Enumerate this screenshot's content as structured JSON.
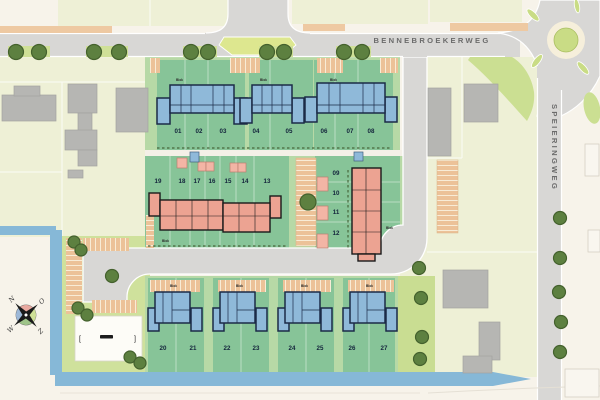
{
  "streets": {
    "main_road": "BENNEBROEKERWEG",
    "side_road": "SPEIERINGWEG"
  },
  "compass": {
    "north": "N",
    "east": "O",
    "south": "Z",
    "west": "W"
  },
  "block_label_text": "Blok",
  "site_sign": {
    "bracket_left": "[",
    "bracket_right": "]"
  },
  "plots": [
    {
      "n": "01",
      "x": 178,
      "y": 133
    },
    {
      "n": "02",
      "x": 199,
      "y": 133
    },
    {
      "n": "03",
      "x": 223,
      "y": 133
    },
    {
      "n": "04",
      "x": 256,
      "y": 133
    },
    {
      "n": "05",
      "x": 289,
      "y": 133
    },
    {
      "n": "06",
      "x": 324,
      "y": 133
    },
    {
      "n": "07",
      "x": 350,
      "y": 133
    },
    {
      "n": "08",
      "x": 371,
      "y": 133
    },
    {
      "n": "09",
      "x": 336,
      "y": 175
    },
    {
      "n": "10",
      "x": 336,
      "y": 195
    },
    {
      "n": "11",
      "x": 336,
      "y": 214
    },
    {
      "n": "12",
      "x": 336,
      "y": 235
    },
    {
      "n": "13",
      "x": 267,
      "y": 183
    },
    {
      "n": "14",
      "x": 245,
      "y": 183
    },
    {
      "n": "15",
      "x": 228,
      "y": 183
    },
    {
      "n": "16",
      "x": 212,
      "y": 183
    },
    {
      "n": "17",
      "x": 197,
      "y": 183
    },
    {
      "n": "18",
      "x": 182,
      "y": 183
    },
    {
      "n": "19",
      "x": 158,
      "y": 183
    },
    {
      "n": "20",
      "x": 163,
      "y": 350
    },
    {
      "n": "21",
      "x": 193,
      "y": 350
    },
    {
      "n": "22",
      "x": 227,
      "y": 350
    },
    {
      "n": "23",
      "x": 256,
      "y": 350
    },
    {
      "n": "24",
      "x": 292,
      "y": 350
    },
    {
      "n": "25",
      "x": 320,
      "y": 350
    },
    {
      "n": "26",
      "x": 352,
      "y": 350
    },
    {
      "n": "27",
      "x": 384,
      "y": 350
    }
  ],
  "block_labels": [
    {
      "x": 176,
      "y": 81
    },
    {
      "x": 260,
      "y": 81
    },
    {
      "x": 330,
      "y": 81
    },
    {
      "x": 162,
      "y": 242
    },
    {
      "x": 386,
      "y": 229
    },
    {
      "x": 170,
      "y": 287
    },
    {
      "x": 236,
      "y": 287
    },
    {
      "x": 301,
      "y": 287
    },
    {
      "x": 366,
      "y": 287
    }
  ],
  "trees": [
    [
      16,
      52,
      7.5
    ],
    [
      39,
      52,
      7.5
    ],
    [
      94,
      52,
      7.5
    ],
    [
      119,
      52,
      7.5
    ],
    [
      191,
      52,
      7.5
    ],
    [
      208,
      52,
      7.5
    ],
    [
      267,
      52,
      7.5
    ],
    [
      284,
      52,
      7.5
    ],
    [
      344,
      52,
      7.5
    ],
    [
      362,
      52,
      7.5
    ],
    [
      308,
      202,
      8
    ],
    [
      112,
      276,
      6.5
    ],
    [
      74,
      242,
      6
    ],
    [
      81,
      250,
      6
    ],
    [
      78,
      308,
      6
    ],
    [
      87,
      315,
      6
    ],
    [
      130,
      357,
      6
    ],
    [
      140,
      363,
      6
    ],
    [
      419,
      268,
      6.5
    ],
    [
      421,
      298,
      6.5
    ],
    [
      422,
      337,
      6.5
    ],
    [
      420,
      359,
      6.5
    ],
    [
      560,
      218,
      6.5
    ],
    [
      560,
      258,
      6.5
    ],
    [
      559,
      292,
      6.5
    ],
    [
      561,
      322,
      6.5
    ],
    [
      560,
      352,
      6.5
    ]
  ],
  "colors": {
    "background": "#f7f3ea",
    "existing_parcel": "#eef0d6",
    "lawn": "#cfe19c",
    "parcel_light_green": "#b7d9a6",
    "parcel_green": "#87c498",
    "verge_green": "#cfe097",
    "road": "#d8d7d5",
    "water": "#86b8d7",
    "house_blue": "#8fb9d9",
    "house_pink": "#eca392",
    "parking_tan": "#ecc298",
    "existing_building": "#b6b6b3",
    "tree": "#5d8040",
    "island_green": "#dde78f",
    "roundabout_center": "#c9dc85"
  }
}
